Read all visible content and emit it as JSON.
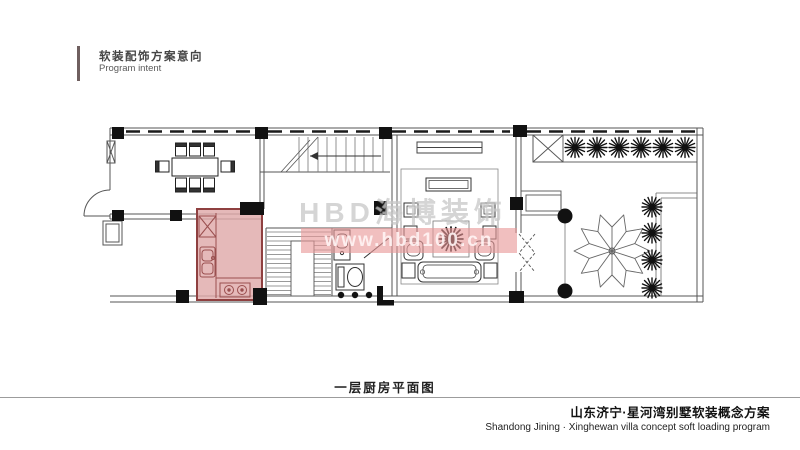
{
  "header": {
    "title_cn": "软装配饰方案意向",
    "title_en": "Program intent"
  },
  "watermark": {
    "brand": "HBD海博装饰",
    "url": "www.hbd100.cn"
  },
  "plan": {
    "caption": "一层厨房平面图",
    "highlight_room": "kitchen",
    "highlight_fill": "#dfa9a9",
    "highlight_border": "#8f4040"
  },
  "footer": {
    "title_cn": "山东济宁·星河湾别墅软装概念方案",
    "title_en": "Shandong Jining · Xinghewan villa concept soft loading program"
  }
}
